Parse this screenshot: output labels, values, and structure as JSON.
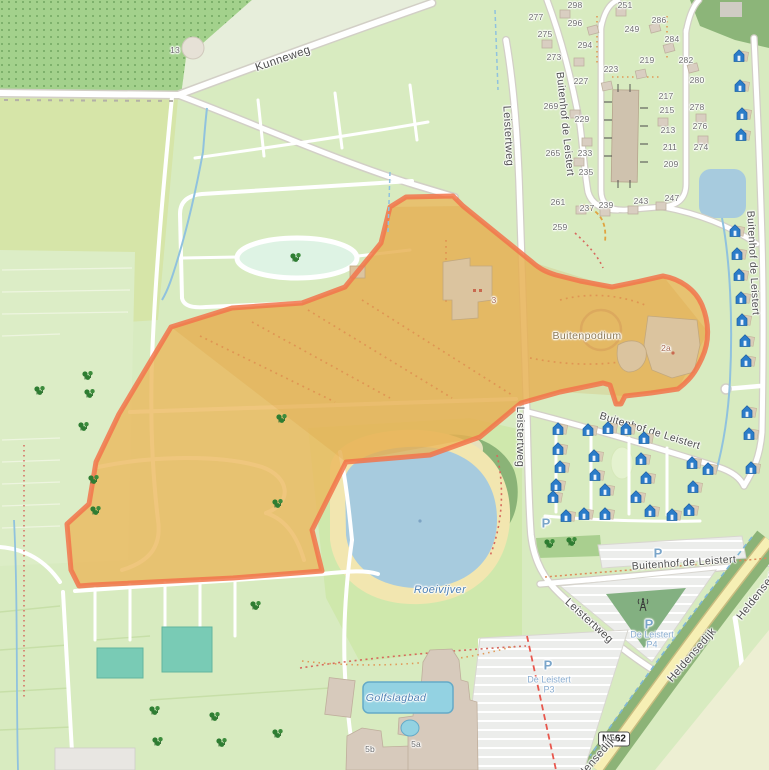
{
  "map": {
    "badge": {
      "text": "N562"
    },
    "street_labels": [
      {
        "text": "Kunneweg",
        "x": 283,
        "y": 59,
        "rot": -19,
        "size": 11.5
      },
      {
        "text": "Leistertweg",
        "x": 508,
        "y": 136,
        "rot": 87,
        "size": 11
      },
      {
        "text": "Buitenhof de Leistert",
        "x": 565,
        "y": 124,
        "rot": 84,
        "size": 10.5
      },
      {
        "text": "Buitenhof de Leistert",
        "x": 753,
        "y": 263,
        "rot": 87,
        "size": 10.5
      },
      {
        "text": "Leistertweg",
        "x": 520,
        "y": 437,
        "rot": 90,
        "size": 11
      },
      {
        "text": "Buitenhof de Leistert",
        "x": 650,
        "y": 431,
        "rot": 17,
        "size": 10.5
      },
      {
        "text": "Buitenhof de Leistert",
        "x": 684,
        "y": 563,
        "rot": -4,
        "size": 10.5
      },
      {
        "text": "Leistertweg",
        "x": 589,
        "y": 621,
        "rot": 42,
        "size": 11
      },
      {
        "text": "Heldensedijk",
        "x": 692,
        "y": 655,
        "rot": -49,
        "size": 11
      },
      {
        "text": "Heldensedijk",
        "x": 760,
        "y": 592,
        "rot": -52,
        "size": 11
      },
      {
        "text": "Heldensedijk",
        "x": 592,
        "y": 763,
        "rot": -49,
        "size": 11
      }
    ],
    "place_labels": [
      {
        "text": "Buitenpodium",
        "x": 587,
        "y": 336,
        "color": "#8d7a55",
        "size": 10.5,
        "italic": false
      },
      {
        "text": "Roeivijver",
        "x": 440,
        "y": 590,
        "color": "#4d80b3",
        "size": 11,
        "italic": true
      },
      {
        "text": "Golfslagbad",
        "x": 396,
        "y": 698,
        "color": "#4d80b3",
        "size": 10.5,
        "italic": true
      }
    ],
    "parking_symbol": "P",
    "parking_icons": [
      [
        546,
        523
      ],
      [
        658,
        553
      ],
      [
        649,
        624
      ],
      [
        548,
        665
      ]
    ],
    "parking_labels": [
      {
        "line1": "De Leistert",
        "line2": "P4",
        "x": 652,
        "y": 640
      },
      {
        "line1": "De Leistert",
        "line2": "P3",
        "x": 549,
        "y": 685
      }
    ],
    "house_numbers": [
      {
        "t": "298",
        "x": 575,
        "y": 5
      },
      {
        "t": "251",
        "x": 625,
        "y": 5
      },
      {
        "t": "277",
        "x": 536,
        "y": 17
      },
      {
        "t": "296",
        "x": 575,
        "y": 23
      },
      {
        "t": "286",
        "x": 659,
        "y": 20
      },
      {
        "t": "275",
        "x": 545,
        "y": 34
      },
      {
        "t": "249",
        "x": 632,
        "y": 29
      },
      {
        "t": "284",
        "x": 672,
        "y": 39
      },
      {
        "t": "294",
        "x": 585,
        "y": 45
      },
      {
        "t": "273",
        "x": 554,
        "y": 57
      },
      {
        "t": "219",
        "x": 647,
        "y": 60
      },
      {
        "t": "282",
        "x": 686,
        "y": 60
      },
      {
        "t": "223",
        "x": 611,
        "y": 69
      },
      {
        "t": "227",
        "x": 581,
        "y": 81
      },
      {
        "t": "280",
        "x": 697,
        "y": 80
      },
      {
        "t": "217",
        "x": 666,
        "y": 96
      },
      {
        "t": "269",
        "x": 551,
        "y": 106
      },
      {
        "t": "278",
        "x": 697,
        "y": 107
      },
      {
        "t": "215",
        "x": 667,
        "y": 110
      },
      {
        "t": "229",
        "x": 582,
        "y": 119
      },
      {
        "t": "276",
        "x": 700,
        "y": 126
      },
      {
        "t": "213",
        "x": 668,
        "y": 130
      },
      {
        "t": "265",
        "x": 553,
        "y": 153
      },
      {
        "t": "233",
        "x": 585,
        "y": 153
      },
      {
        "t": "211",
        "x": 670,
        "y": 147
      },
      {
        "t": "274",
        "x": 701,
        "y": 147
      },
      {
        "t": "235",
        "x": 586,
        "y": 172
      },
      {
        "t": "209",
        "x": 671,
        "y": 164
      },
      {
        "t": "261",
        "x": 558,
        "y": 202
      },
      {
        "t": "237",
        "x": 587,
        "y": 208
      },
      {
        "t": "239",
        "x": 606,
        "y": 205
      },
      {
        "t": "243",
        "x": 641,
        "y": 201
      },
      {
        "t": "247",
        "x": 672,
        "y": 198
      },
      {
        "t": "259",
        "x": 560,
        "y": 227
      },
      {
        "t": "13",
        "x": 175,
        "y": 50
      },
      {
        "t": "3",
        "x": 494,
        "y": 300,
        "c": "#a66a52"
      },
      {
        "t": "2a",
        "x": 666,
        "y": 348,
        "c": "#a66a52"
      },
      {
        "t": "5b",
        "x": 370,
        "y": 749
      },
      {
        "t": "5a",
        "x": 416,
        "y": 744
      }
    ],
    "chalets": [
      [
        741,
        58
      ],
      [
        742,
        88
      ],
      [
        744,
        116
      ],
      [
        743,
        137
      ],
      [
        737,
        233
      ],
      [
        739,
        256
      ],
      [
        741,
        277
      ],
      [
        743,
        300
      ],
      [
        744,
        322
      ],
      [
        747,
        343
      ],
      [
        748,
        363
      ],
      [
        749,
        414
      ],
      [
        751,
        436
      ],
      [
        753,
        470
      ],
      [
        560,
        431
      ],
      [
        590,
        432
      ],
      [
        610,
        430
      ],
      [
        628,
        431
      ],
      [
        646,
        440
      ],
      [
        560,
        451
      ],
      [
        596,
        458
      ],
      [
        562,
        469
      ],
      [
        643,
        461
      ],
      [
        694,
        465
      ],
      [
        710,
        471
      ],
      [
        597,
        477
      ],
      [
        648,
        480
      ],
      [
        558,
        487
      ],
      [
        695,
        489
      ],
      [
        607,
        492
      ],
      [
        555,
        499
      ],
      [
        638,
        499
      ],
      [
        568,
        518
      ],
      [
        586,
        516
      ],
      [
        607,
        516
      ],
      [
        652,
        513
      ],
      [
        674,
        517
      ],
      [
        691,
        512
      ]
    ],
    "trees": [
      [
        88,
        379
      ],
      [
        40,
        394
      ],
      [
        90,
        397
      ],
      [
        84,
        430
      ],
      [
        94,
        483
      ],
      [
        96,
        514
      ],
      [
        282,
        422
      ],
      [
        278,
        507
      ],
      [
        256,
        609
      ],
      [
        155,
        714
      ],
      [
        215,
        720
      ],
      [
        222,
        746
      ],
      [
        278,
        737
      ],
      [
        158,
        745
      ],
      [
        296,
        261
      ],
      [
        550,
        547
      ],
      [
        572,
        545
      ]
    ],
    "mast": {
      "x": 643,
      "y": 607
    }
  }
}
